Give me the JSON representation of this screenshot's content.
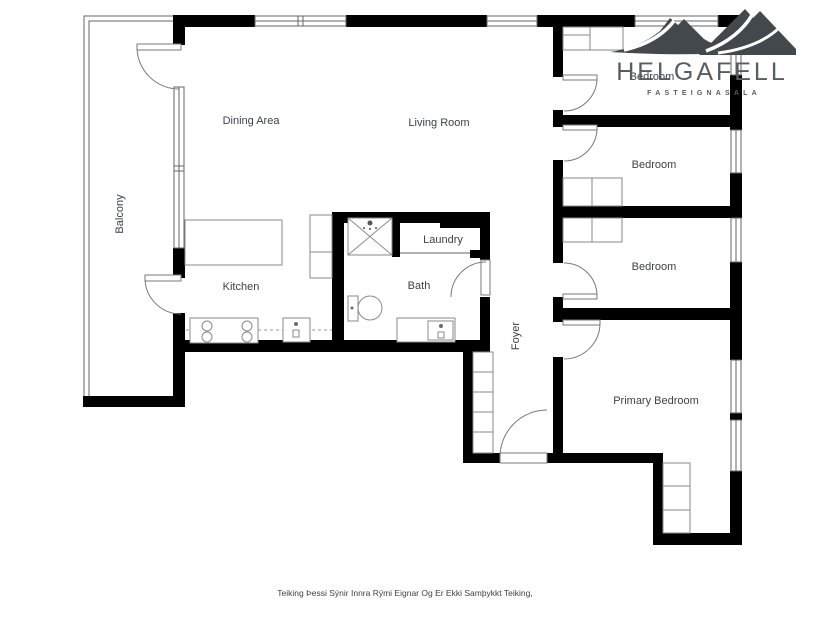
{
  "theme": {
    "bg": "#ffffff",
    "wall": "#000000",
    "line": "#666666",
    "fixture-line": "#8a8a8a",
    "label": "#3d4247",
    "logo": "#43484d",
    "logo-text": "#585d62"
  },
  "branding": {
    "name": "HELGAFELL",
    "tagline": "FASTEIGNASALA"
  },
  "rooms": {
    "balcony": "Balcony",
    "dining": "Dining Area",
    "living": "Living Room",
    "kitchen": "Kitchen",
    "laundry": "Laundry",
    "bath": "Bath",
    "foyer": "Foyer",
    "bedroom_top": "Bedroom",
    "bedroom_middle": "Bedroom",
    "bedroom_lower": "Bedroom",
    "primary": "Primary Bedroom"
  },
  "disclaimer": "Teiking Þessi Sýnir Innra Rými Eignar Og Er Ekki Samþykkt Teiking,"
}
